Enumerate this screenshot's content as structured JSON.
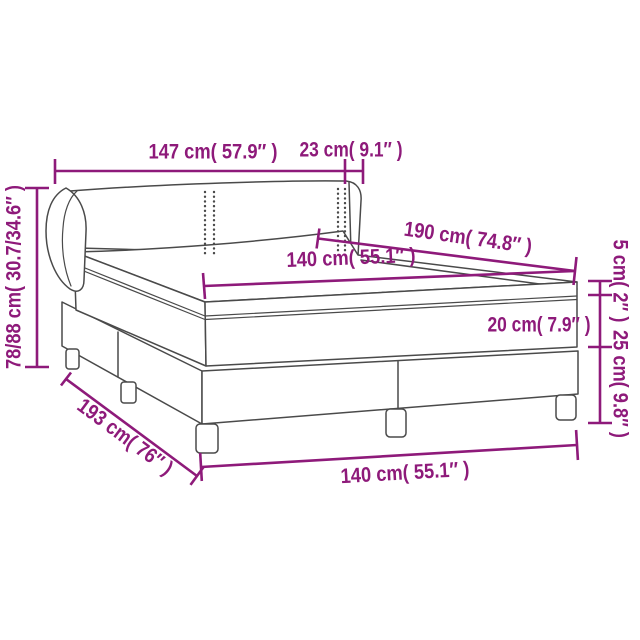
{
  "diagram": {
    "subject": "box-spring-bed-dimension-diagram",
    "colors": {
      "dimension_accent": "#8e1a7a",
      "line_art": "#4a4a4a",
      "background": "#ffffff"
    },
    "measurements": {
      "headboard_width": {
        "text": "147 cm( 57.9″ )",
        "cm": "147",
        "inches": "57.9"
      },
      "wing_depth": {
        "text": "23 cm( 9.1″ )",
        "cm": "23",
        "inches": "9.1"
      },
      "bed_length": {
        "text": "190 cm( 74.8″ )",
        "cm": "190",
        "inches": "74.8"
      },
      "mattress_width": {
        "text": "140 cm( 55.1″ )",
        "cm": "140",
        "inches": "55.1"
      },
      "topper_height": {
        "text": "5 cm( 2″ )",
        "cm": "5",
        "inches": "2"
      },
      "mattress_height": {
        "text": "20 cm( 7.9″ )",
        "cm": "20",
        "inches": "7.9"
      },
      "base_height": {
        "text": "25 cm( 9.8″ )",
        "cm": "25",
        "inches": "9.8"
      },
      "total_height": {
        "text": "78/88 cm( 30.7/34.6″ )",
        "cm": "78/88",
        "inches": "30.7/34.6"
      },
      "base_length": {
        "text": "193 cm( 76″ )",
        "cm": "193",
        "inches": "76"
      },
      "base_width": {
        "text": "140 cm( 55.1″ )",
        "cm": "140",
        "inches": "55.1"
      }
    }
  }
}
